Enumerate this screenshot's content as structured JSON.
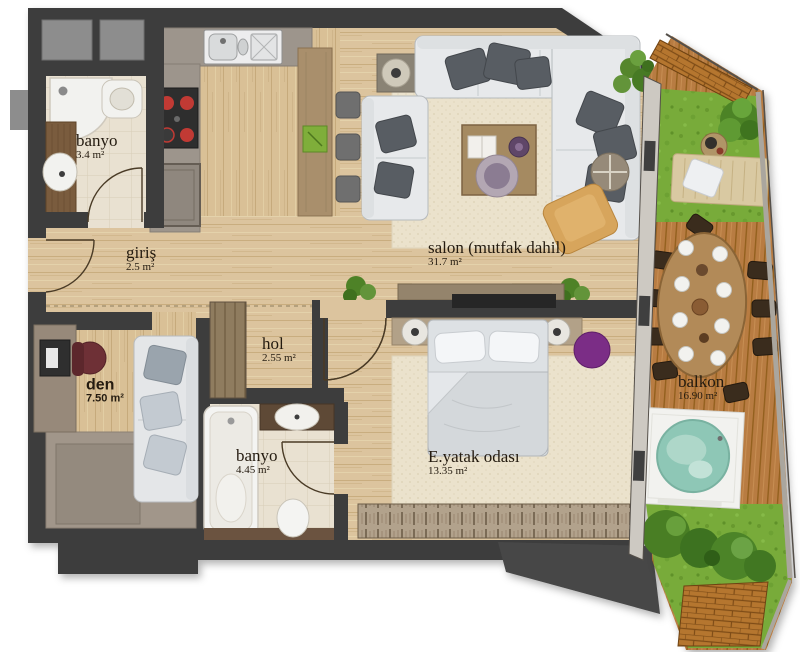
{
  "plan": {
    "rooms": {
      "banyo1": {
        "name": "banyo",
        "area": "3.4 m²"
      },
      "giris": {
        "name": "giriş",
        "area": "2.5 m²"
      },
      "salon": {
        "name": "salon (mutfak dahil)",
        "area": "31.7 m²"
      },
      "den": {
        "name": "den",
        "area": "7.50 m²"
      },
      "hol": {
        "name": "hol",
        "area": "2.55 m²"
      },
      "banyo2": {
        "name": "banyo",
        "area": "4.45 m²"
      },
      "master_bedroom": {
        "name": "E.yatak odası",
        "area": "13.35 m²"
      },
      "balcony": {
        "name": "balkon",
        "area": "16.90 m²"
      }
    },
    "colors": {
      "wall": "#3d3d3d",
      "wood_floor": "#dcc49e",
      "tile_floor": "#e9e1d1",
      "kitchen_counter": "#9d958c",
      "deck_wood": "#b87c42",
      "grass": "#78ab3a",
      "jacuzzi_water": "#8ec7b6",
      "accent_purple": "#7b2d86"
    }
  }
}
